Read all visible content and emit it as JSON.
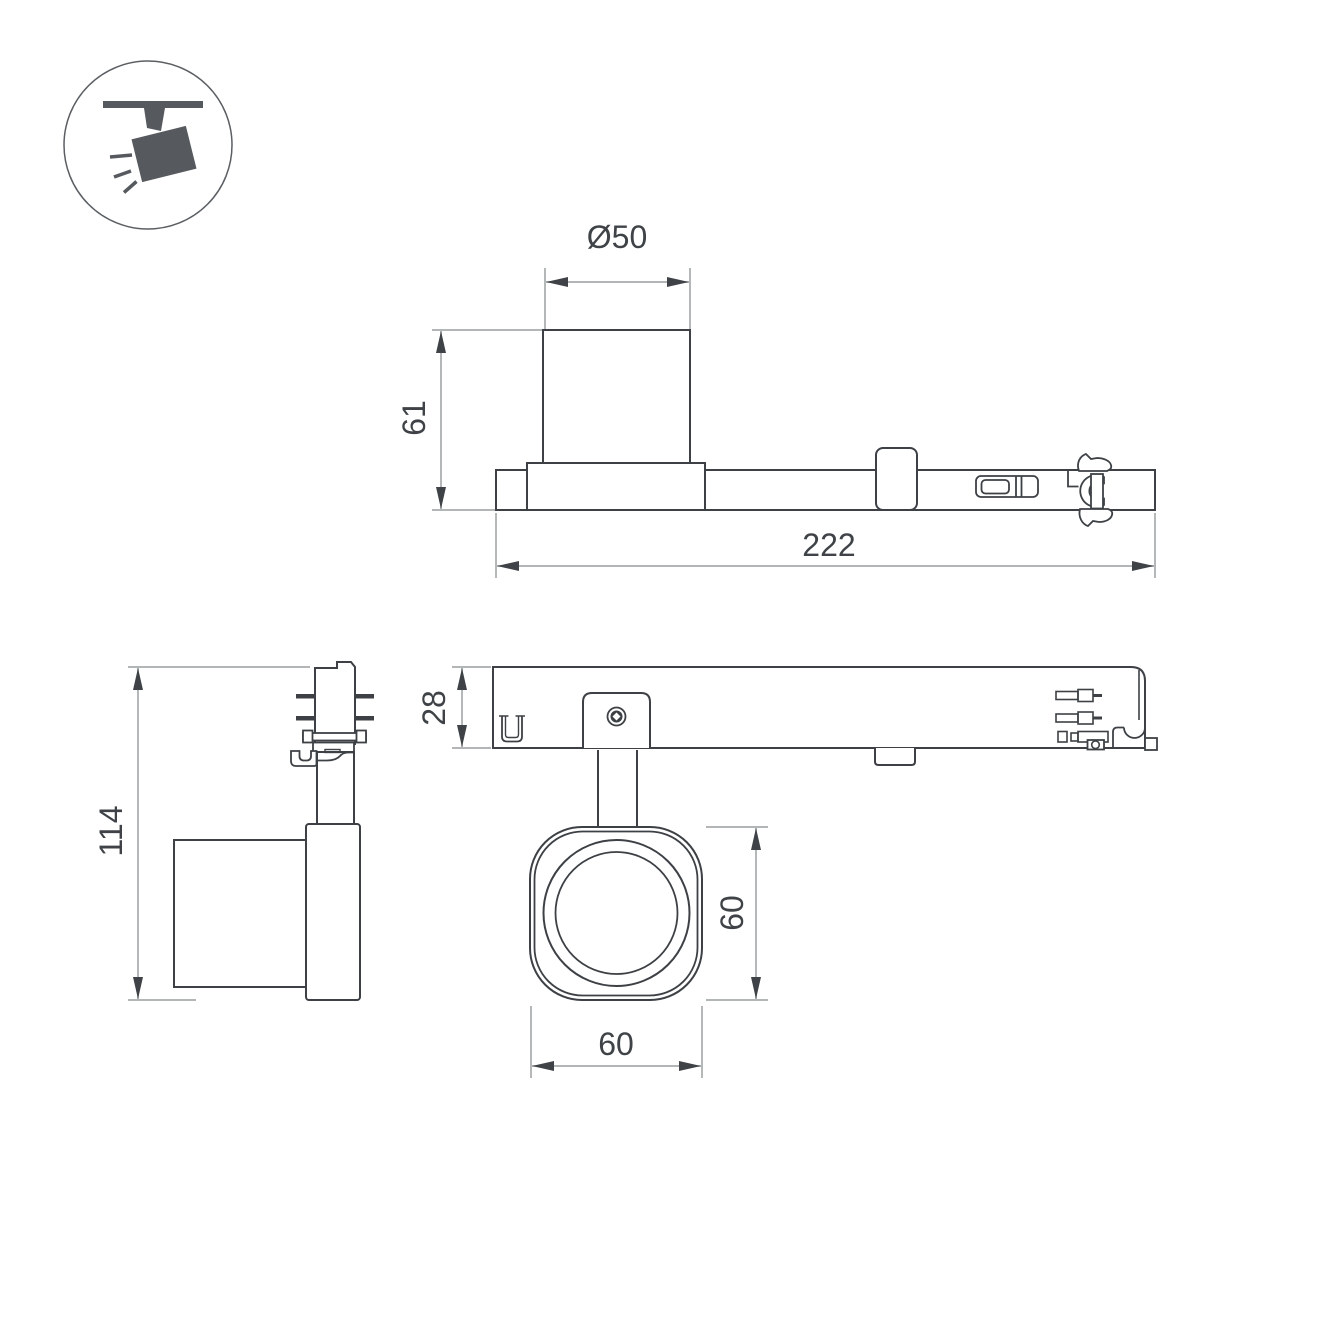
{
  "drawing": {
    "icon": {
      "name": "track-spotlight-icon"
    },
    "dimensions": {
      "side_view": {
        "diameter": "Ø50",
        "height": "61",
        "length": "222"
      },
      "end_view": {
        "height": "114"
      },
      "bottom_view": {
        "track_height": "28",
        "head_height": "60",
        "head_width": "60"
      }
    },
    "colors": {
      "background": "#ffffff",
      "outline": "#3d4145",
      "dimension": "#a8abad",
      "text": "#3f4347",
      "icon_fill": "#565a5e"
    }
  }
}
